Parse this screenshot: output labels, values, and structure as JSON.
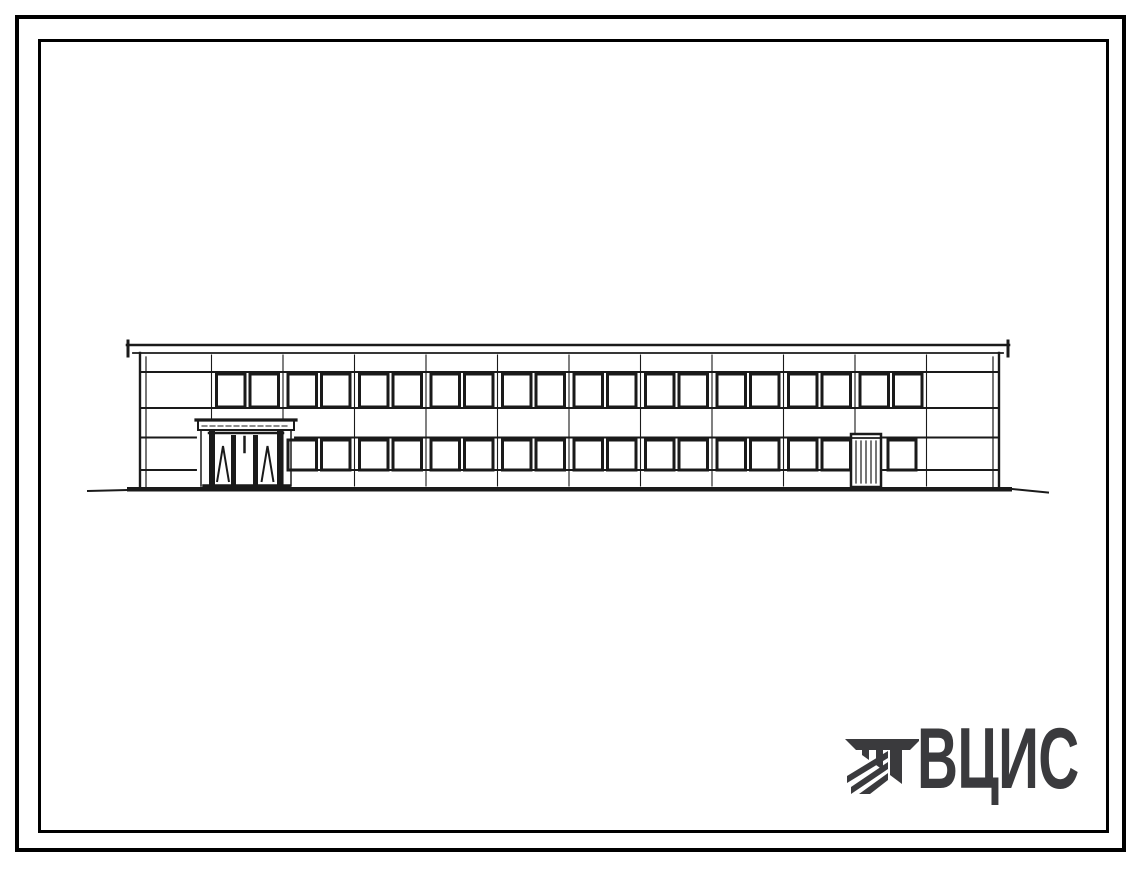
{
  "sheet": {
    "description": "building front elevation line drawing on bordered sheet",
    "width": 1139,
    "height": 869
  },
  "colors": {
    "paper": "#ffffff",
    "frame": "#000000",
    "ink": "#1a1a1a",
    "logo": "#3a3a3d"
  },
  "logo": {
    "text": "ВЦИС",
    "icon": "vcis-construction-mark",
    "color": "#3a3a3d"
  },
  "elevation": {
    "roof": {
      "x1": 127,
      "x2": 1009,
      "y_top": 345,
      "y_bottom": 353
    },
    "wall": {
      "left": 140,
      "right": 999,
      "top": 353,
      "bottom": 487
    },
    "inner_wall_lines": [
      146,
      993
    ],
    "band_lines_y": [
      372,
      408,
      437.5,
      470
    ],
    "band_gaps": [
      {
        "bands": [
          2,
          3
        ],
        "x1": 196,
        "x2": 295
      },
      {
        "bands": [
          2,
          3
        ],
        "x1": 849,
        "x2": 883
      }
    ],
    "bay_first_x": 140,
    "bay_width": 71.5,
    "bay_joint_count": 11,
    "windows": {
      "w": 28.5,
      "offsets": [
        5,
        38.5
      ],
      "upper": {
        "y": 374,
        "h": 33,
        "bays": [
          1,
          2,
          3,
          4,
          5,
          6,
          7,
          8,
          9,
          10
        ]
      },
      "lower": {
        "y": 440,
        "h": 30,
        "bays": [
          2,
          3,
          4,
          5,
          6,
          7,
          8,
          9
        ]
      },
      "extra": [
        {
          "x": 888,
          "y": 440,
          "w": 28,
          "h": 30
        }
      ]
    },
    "entrance": {
      "canopy": {
        "x": 198,
        "y": 420,
        "w": 96,
        "h": 10
      },
      "posts_x": [
        209,
        277
      ],
      "post_w": 6,
      "door_top": 431,
      "mullions_x": [
        231,
        253
      ],
      "mullion_w": 5,
      "panel_marks": [
        "lambda",
        "tick",
        "lambda"
      ],
      "threshold": {
        "x1": 204,
        "x2": 289,
        "y": 486
      }
    },
    "side_door": {
      "x": 851,
      "y": 434,
      "w": 30,
      "h": 53
    },
    "ground": {
      "x1": 127,
      "x2": 1012,
      "y": 487,
      "h": 4.5,
      "ext_left_x": 88,
      "ext_right_x": 1048
    }
  }
}
